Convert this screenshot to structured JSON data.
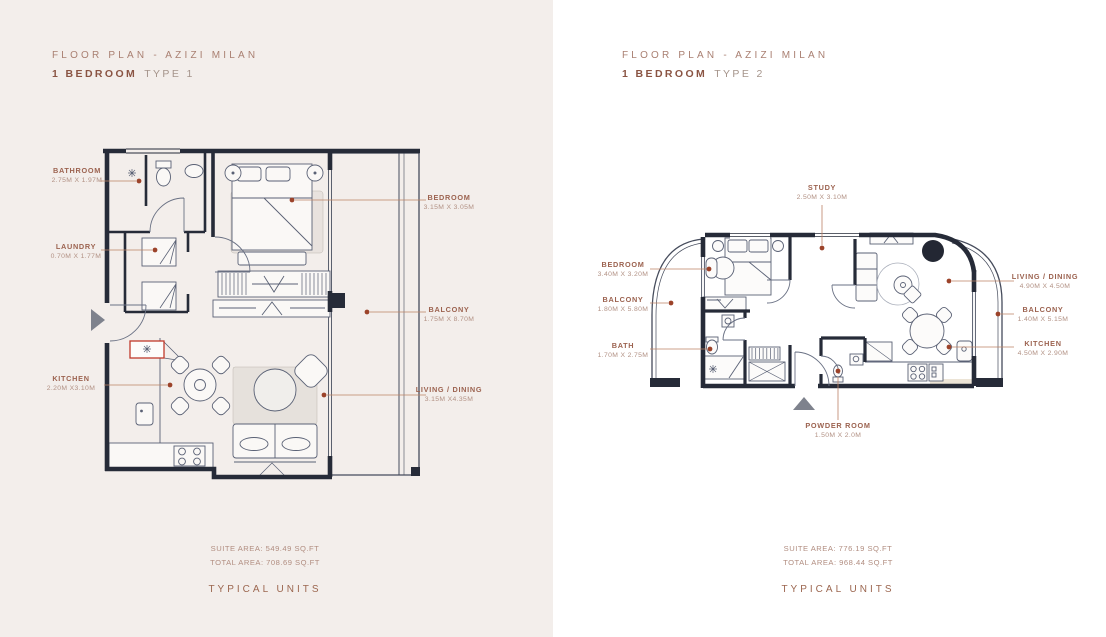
{
  "left": {
    "header": {
      "line1": "FLOOR PLAN - AZIZI MILAN",
      "bold": "1 BEDROOM",
      "type": "TYPE 1"
    },
    "labels": {
      "bathroom": {
        "name": "BATHROOM",
        "dims": "2.75M X 1.97M"
      },
      "laundry": {
        "name": "LAUNDRY",
        "dims": "0.70M X 1.77M"
      },
      "kitchen": {
        "name": "KITCHEN",
        "dims": "2.20M X3.10M"
      },
      "bedroom": {
        "name": "BEDROOM",
        "dims": "3.15M X 3.05M"
      },
      "balcony": {
        "name": "BALCONY",
        "dims": "1.75M X 8.70M"
      },
      "living": {
        "name": "LIVING / DINING",
        "dims": "3.15M X4.35M"
      }
    },
    "suite_area": "SUITE AREA: 549.49 SQ.FT",
    "total_area": "TOTAL AREA: 708.69 SQ.FT",
    "footer": "TYPICAL UNITS"
  },
  "right": {
    "header": {
      "line1": "FLOOR PLAN - AZIZI MILAN",
      "bold": "1 BEDROOM",
      "type": "TYPE 2"
    },
    "labels": {
      "study": {
        "name": "STUDY",
        "dims": "2.50M X 3.10M"
      },
      "bedroom": {
        "name": "BEDROOM",
        "dims": "3.40M X 3.20M"
      },
      "balcony_left": {
        "name": "BALCONY",
        "dims": "1.80M X 5.80M"
      },
      "bath": {
        "name": "BATH",
        "dims": "1.70M X 2.75M"
      },
      "living": {
        "name": "LIVING / DINING",
        "dims": "4.90M X 4.50M"
      },
      "balcony_right": {
        "name": "BALCONY",
        "dims": "1.40M X 5.15M"
      },
      "kitchen": {
        "name": "KITCHEN",
        "dims": "4.50M X 2.90M"
      },
      "powder": {
        "name": "POWDER ROOM",
        "dims": "1.50M X 2.0M"
      }
    },
    "suite_area": "SUITE AREA: 776.19 SQ.FT",
    "total_area": "TOTAL AREA: 968.44 SQ.FT",
    "footer": "TYPICAL UNITS"
  },
  "colors": {
    "accent_dot": "#9c432a",
    "wall": "#262b38",
    "title_bold": "#8a5443",
    "panel_left_bg": "#f3eeeb"
  }
}
